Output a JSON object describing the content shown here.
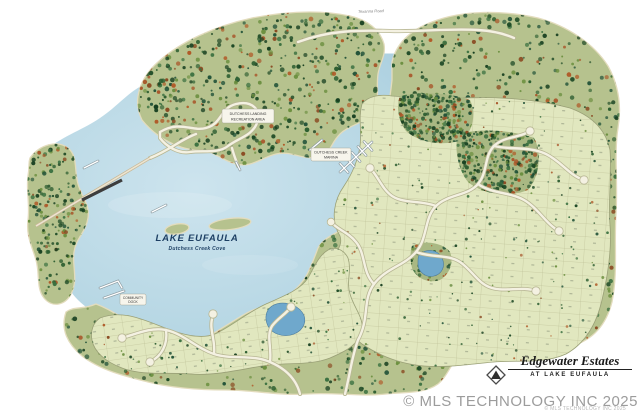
{
  "map": {
    "lake": {
      "name": "LAKE EUFAULA",
      "cove": "Dutchess Creek Cove"
    },
    "labels": {
      "recreation_area": [
        "DUTCHESS LANDING",
        "RECREATION AREA"
      ],
      "marina": [
        "DUTCHESS CREEK",
        "MARINA"
      ],
      "community_dock": [
        "COMMUNITY",
        "DOCK"
      ],
      "road": "Texanna Road"
    },
    "colors": {
      "water": "#b7d7e4",
      "forest": "#b6c28e",
      "lots": "#e1e7bf",
      "road": "#f4f1e2",
      "pond": "#6fa8cc",
      "tree_dark": "#1e4a26",
      "tree_rust": "#a8562a"
    }
  },
  "title_block": {
    "name": "Edgewater Estates",
    "subtitle": "AT LAKE EUFAULA"
  },
  "watermark": {
    "text": "© MLS TECHNOLOGY INC 2025",
    "text_small": "© MLS TECHNOLOGY INC 2025"
  }
}
